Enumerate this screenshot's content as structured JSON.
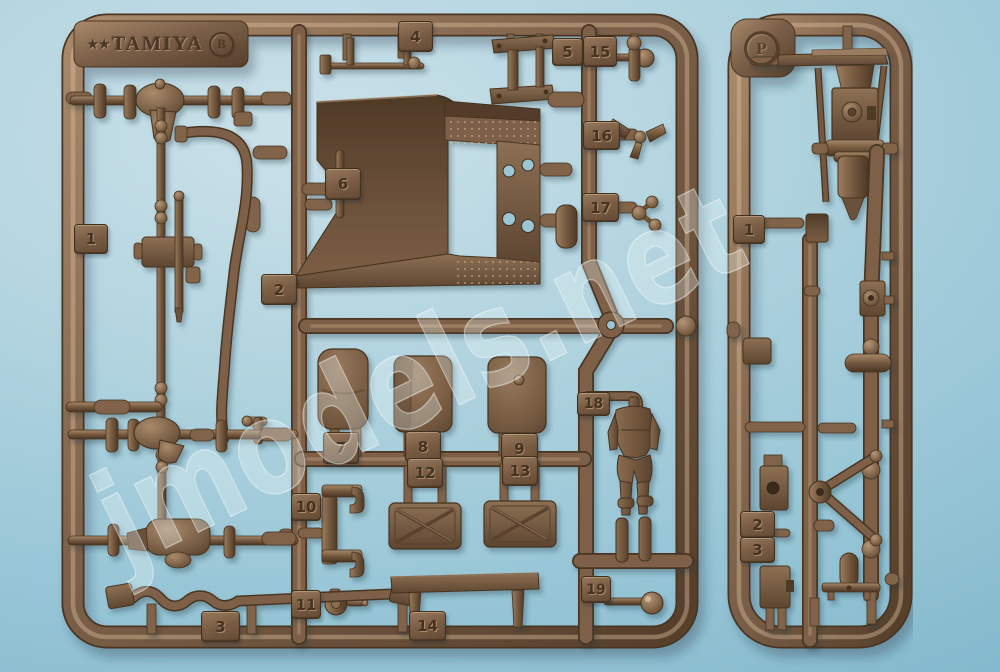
{
  "colors": {
    "background": "#a8cedb",
    "plastic_base": "#7b6049",
    "plastic_highlight": "#b59578",
    "plastic_shadow": "#3f2e1e",
    "watermark": "#ffffff"
  },
  "watermark": {
    "text": "jmodels.net"
  },
  "sprue_b": {
    "brand_stars": "★★",
    "brand_name": "TAMIYA",
    "letter": "B",
    "tags": {
      "t1": "1",
      "t2": "2",
      "t3": "3",
      "t4": "4",
      "t5": "5",
      "t6": "6",
      "t7": "7",
      "t8": "8",
      "t9": "9",
      "t10": "10",
      "t11": "11",
      "t12": "12",
      "t13": "13",
      "t14": "14",
      "t15": "15",
      "t16": "16",
      "t17": "17",
      "t18": "18",
      "t19": "19"
    }
  },
  "sprue_p": {
    "letter": "P",
    "tags": {
      "t1": "1",
      "t2": "2",
      "t3": "3"
    }
  }
}
